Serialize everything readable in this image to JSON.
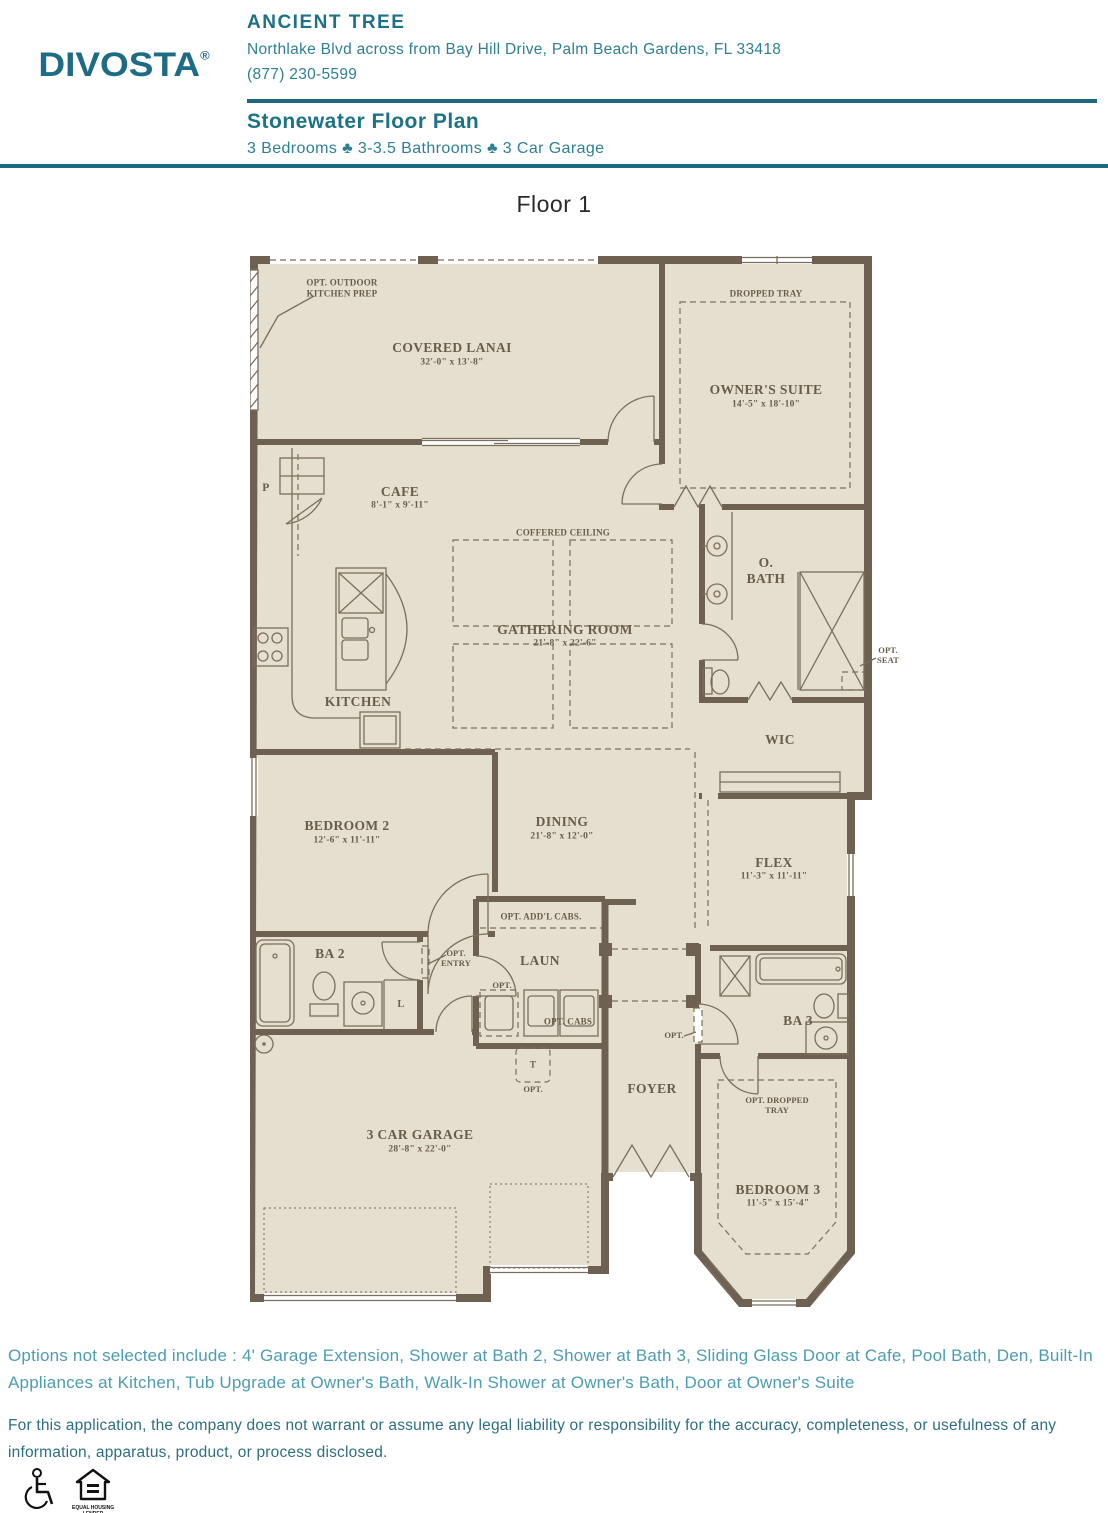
{
  "header": {
    "logo_text": "DIVOSTA",
    "logo_mark": "®",
    "community_name": "ANCIENT TREE",
    "address": "Northlake Blvd across from Bay Hill Drive, Palm Beach Gardens, FL 33418",
    "phone": "(877) 230-5599",
    "plan_name": "Stonewater Floor Plan",
    "specs": "3 Bedrooms ♣ 3-3.5 Bathrooms ♣ 3 Car Garage"
  },
  "floor_label": "Floor 1",
  "plan": {
    "rooms": {
      "covered_lanai": {
        "name": "COVERED LANAI",
        "dims": "32'-0\" x 13'-8\""
      },
      "owners_suite": {
        "name": "OWNER'S SUITE",
        "dims": "14'-5\" x 18'-10\""
      },
      "cafe": {
        "name": "CAFE",
        "dims": "8'-1\" x 9'-11\""
      },
      "gathering_room": {
        "name": "GATHERING ROOM",
        "dims": "21'-8\" x 22'-6\""
      },
      "kitchen": {
        "name": "KITCHEN"
      },
      "owners_bath": {
        "name": "O.\nBATH"
      },
      "wic": {
        "name": "WIC"
      },
      "bedroom2": {
        "name": "BEDROOM 2",
        "dims": "12'-6\" x 11'-11\""
      },
      "dining": {
        "name": "DINING",
        "dims": "21'-8\" x 12'-0\""
      },
      "flex": {
        "name": "FLEX",
        "dims": "11'-3\" x 11'-11\""
      },
      "bath2": {
        "name": "BA 2"
      },
      "laundry": {
        "name": "LAUN"
      },
      "bath3": {
        "name": "BA 3"
      },
      "foyer": {
        "name": "FOYER"
      },
      "garage": {
        "name": "3 CAR GARAGE",
        "dims": "28'-8\" x 22'-0\""
      },
      "bedroom3": {
        "name": "BEDROOM 3",
        "dims": "11'-5\" x 15'-4\""
      }
    },
    "annotations": {
      "opt_outdoor_kitchen": "OPT. OUTDOOR\nKITCHEN PREP",
      "dropped_tray": "DROPPED TRAY",
      "coffered_ceiling": "COFFERED CEILING",
      "opt_seat": "OPT.\nSEAT",
      "pantry": "P",
      "linen": "L",
      "opt_entry": "OPT.\nENTRY",
      "opt_addl_cabs": "OPT. ADD'L CABS.",
      "opt": "OPT.",
      "opt_cabs": "OPT. CABS",
      "tankless": "T",
      "opt_dropped_tray": "OPT. DROPPED\nTRAY"
    }
  },
  "footer": {
    "options_note": "Options not selected include : 4' Garage Extension, Shower at Bath 2, Shower at Bath 3, Sliding Glass Door at Cafe, Pool Bath, Den, Built-In Appliances at Kitchen, Tub Upgrade at Owner's Bath, Walk-In Shower at Owner's Bath, Door at Owner's Suite",
    "disclaimer": "For this application, the company does not warrant or assume any legal liability or responsibility for the accuracy, completeness, or usefulness of any information, apparatus, product, or process disclosed.",
    "equal_housing_caption": "EQUAL HOUSING\nLENDER"
  },
  "colors": {
    "accent_teal": "#1d7285",
    "wall_brown": "#6e6152",
    "floor_beige": "#e4dfcf",
    "options_text": "#4d9cb0",
    "disclaimer_text": "#2e6e80"
  }
}
